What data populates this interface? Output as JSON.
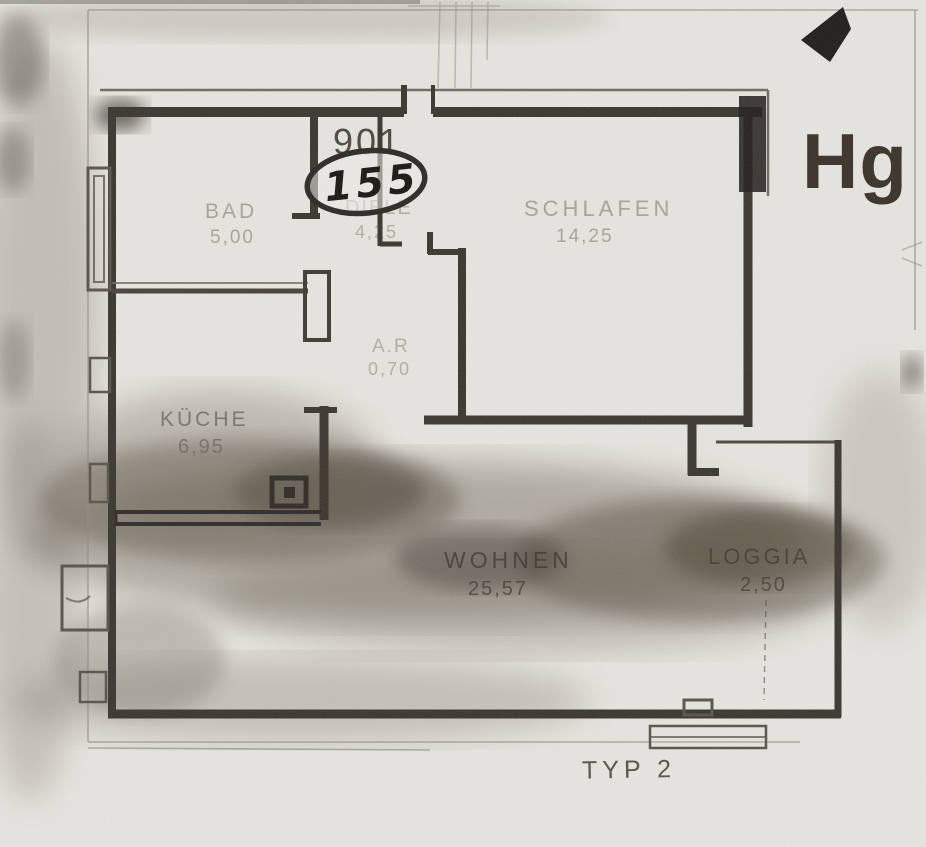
{
  "document": {
    "plan_type": "TYP 2",
    "unit_number": "901",
    "handwritten_number": "155",
    "building_mark": "Hg"
  },
  "rooms": [
    {
      "name": "BAD",
      "area": "5,00"
    },
    {
      "name": "DIELE",
      "area": "4,25"
    },
    {
      "name": "SCHLAFEN",
      "area": "14,25"
    },
    {
      "name": "A.R",
      "area": "0,70"
    },
    {
      "name": "KÜCHE",
      "area": "6,95"
    },
    {
      "name": "WOHNEN",
      "area": "25,57"
    },
    {
      "name": "LOGGIA",
      "area": "2,50"
    }
  ],
  "icons": {
    "direction_arrow": "solid black arrowhead pointing left",
    "stove_symbol": "square outline with filled inner square (kitchen appliance)"
  },
  "colors": {
    "paper": "#edebe6",
    "wall": "#38342e",
    "dark_wall": "#211e1a",
    "faint_text": "#8f8a80",
    "smudge": "#5e5747",
    "ink": "#18150f"
  }
}
